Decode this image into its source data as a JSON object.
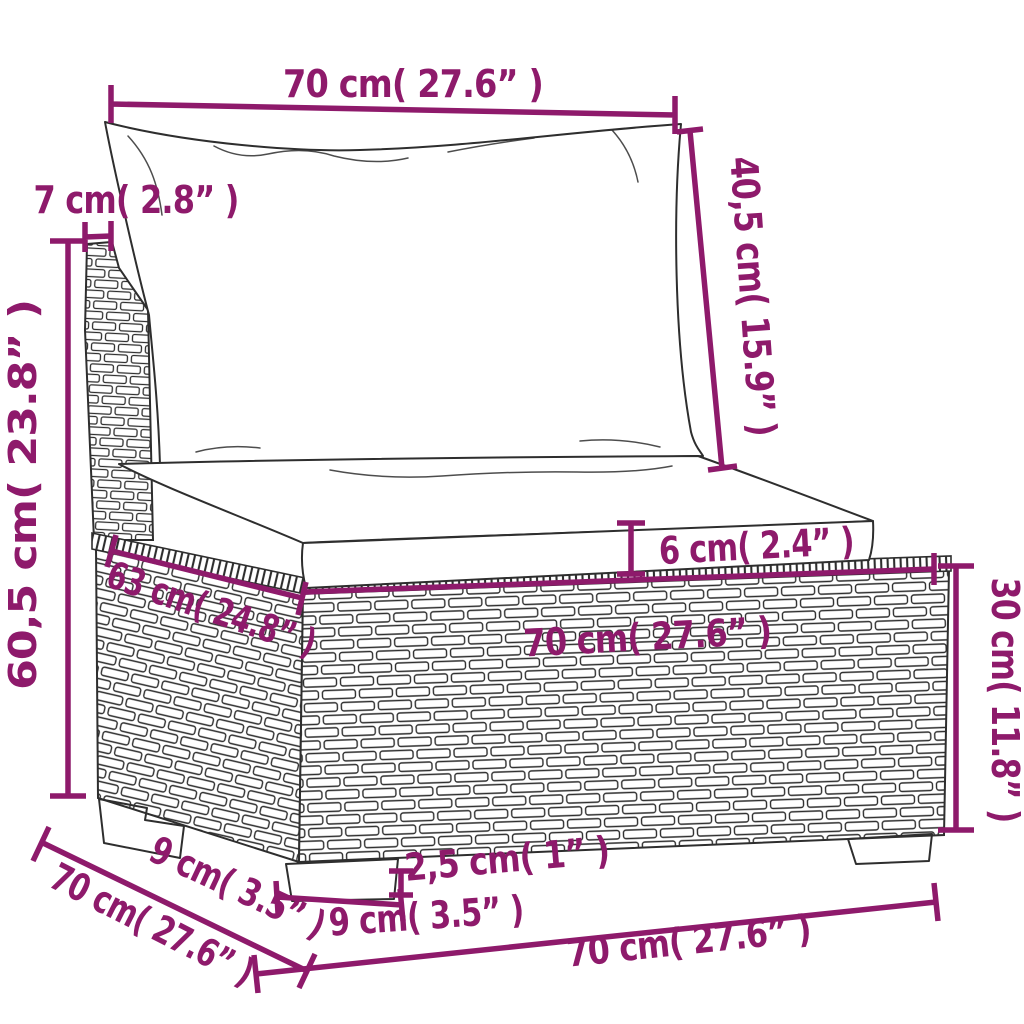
{
  "diagram": {
    "description": "Poly rattan garden middle sofa section with cushions, annotated dimension drawing",
    "colors": {
      "accent": "#8E1A6B",
      "drawing_line": "#2e2e2e",
      "background": "#ffffff"
    }
  },
  "dimensions": {
    "top_width": "70 cm( 27.6” )",
    "back_frame_width": "7 cm( 2.8” )",
    "back_cushion_height": "40,5 cm( 15.9” )",
    "total_height": "60,5 cm( 23.8” )",
    "seat_cushion_thickness": "6 cm( 2.4” )",
    "seat_width": "70 cm( 27.6” )",
    "seat_depth": "63 cm( 24.8” )",
    "base_height": "30 cm( 11.8” )",
    "foot_height": "2,5 cm( 1” )",
    "front_foot_width": "9 cm( 3.5” )",
    "side_foot_width": "9 cm( 3.5” )",
    "total_depth": "70 cm( 27.6” )",
    "bottom_width": "70 cm( 27.6” )"
  }
}
